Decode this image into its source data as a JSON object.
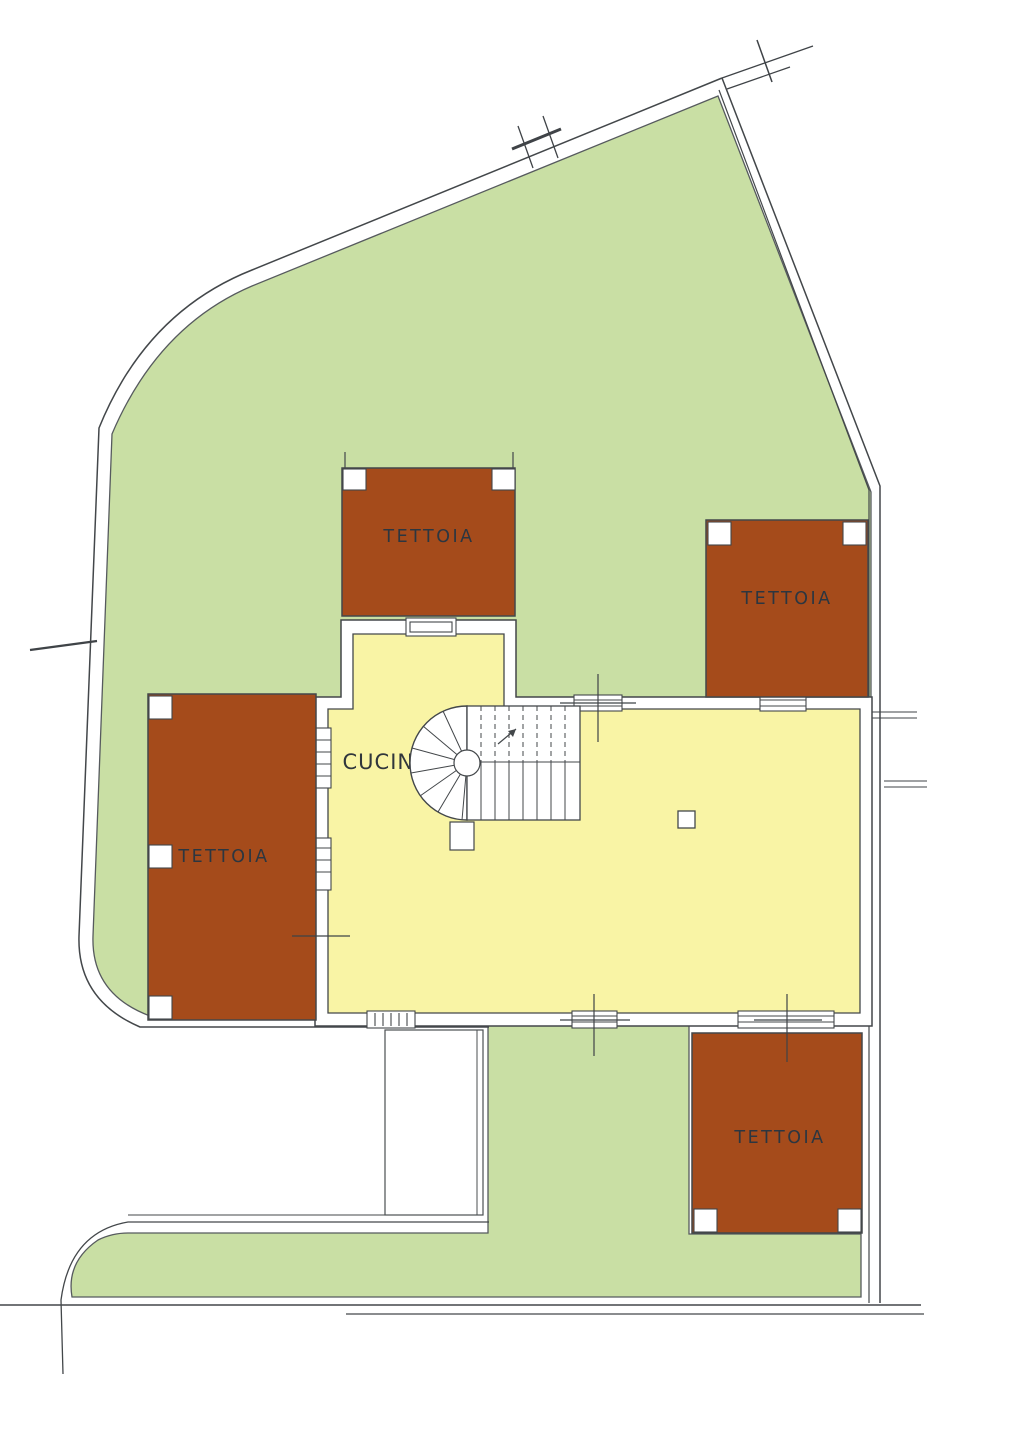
{
  "plan": {
    "title": "site-plan-floorplan",
    "labels": {
      "tettoia_north": "TETTOIA",
      "tettoia_east": "TETTOIA",
      "tettoia_west": "TETTOIA",
      "tettoia_south": "TETTOIA",
      "cucina": "CUCINA"
    },
    "colors": {
      "lawn": "#c9dfa4",
      "building_fill": "#f9f4a5",
      "canopy_fill": "#a54b1b",
      "wall_fill": "#ffffff",
      "line": "#43474a",
      "paper": "#ffffff"
    }
  }
}
